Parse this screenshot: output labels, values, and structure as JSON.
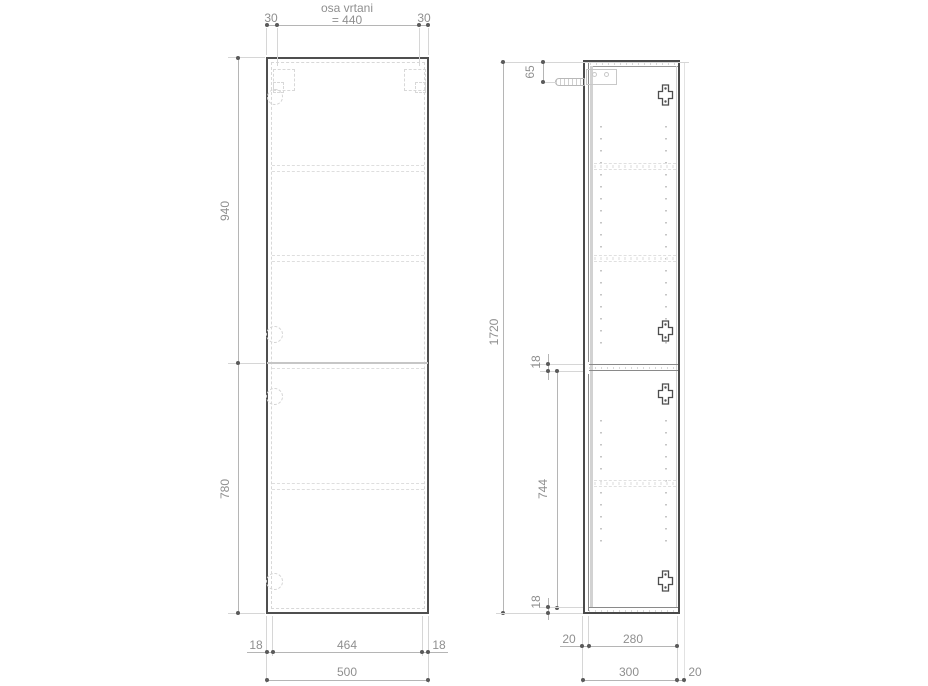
{
  "drawing": {
    "type": "cabinet-technical-drawing",
    "title": "osa vrtani",
    "front": {
      "axis_span": "= 440",
      "margin_left": "30",
      "margin_right": "30",
      "upper_height": "940",
      "lower_height": "780",
      "panel_left": "18",
      "inner_width": "464",
      "panel_right": "18",
      "total_width": "500"
    },
    "side": {
      "hanger_offset": "65",
      "total_height": "1720",
      "divider_panel": "18",
      "lower_inner_height": "744",
      "bottom_panel": "18",
      "door_thickness": "20",
      "inner_depth": "280",
      "total_depth": "300",
      "wall_gap": "20"
    },
    "colors": {
      "outline": "#4f4f4f",
      "dim_line": "#b5b5b5",
      "extension_line": "#d6d6d6",
      "detail_dashed": "#dedede",
      "dim_text": "#8f8f8f",
      "dot": "#5a5a5a",
      "background": "#ffffff"
    },
    "icons": [
      "mounting-bracket-icon",
      "hinge-icon",
      "wall-anchor-icon",
      "hinge-plate-icon"
    ]
  }
}
